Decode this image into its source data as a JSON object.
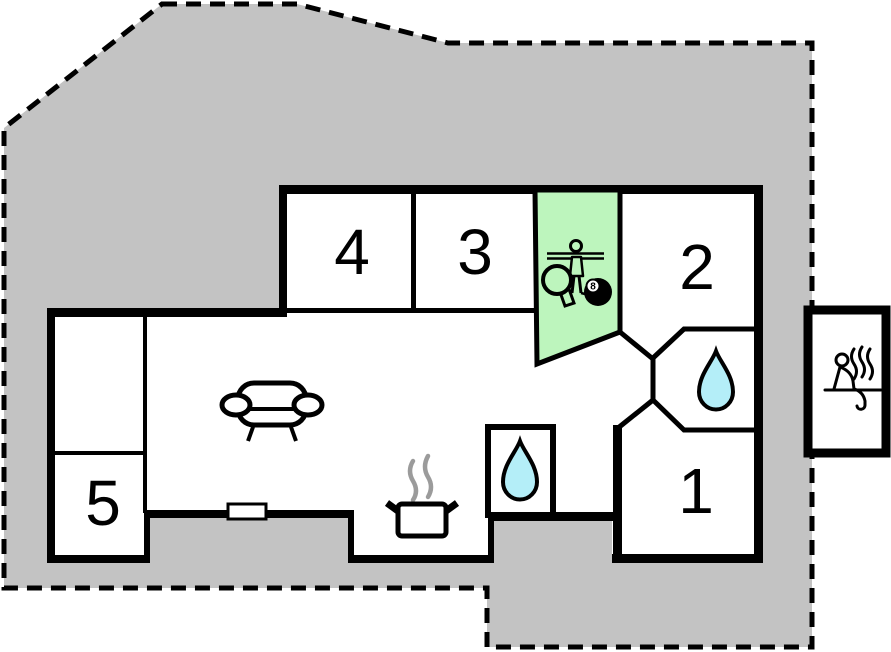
{
  "title": "Holiday home floor plan",
  "colors": {
    "plot_gray": "#c3c3c3",
    "game_room_green": "#bdf5bd",
    "water_drop_cyan": "#b4eef8",
    "wall_black": "#000000",
    "steam_gray": "#9b9b9b"
  },
  "rooms": [
    {
      "id": "room-1",
      "label": "1"
    },
    {
      "id": "room-2",
      "label": "2"
    },
    {
      "id": "room-3",
      "label": "3"
    },
    {
      "id": "room-4",
      "label": "4"
    },
    {
      "id": "room-5",
      "label": "5"
    }
  ],
  "game_room": {
    "eight_ball_label": "8",
    "icons": [
      "foosball-player-icon",
      "table-tennis-paddle-icon",
      "billiard-8ball-icon"
    ]
  },
  "features": {
    "bathroom_icons": [
      "water-drop-icon",
      "water-drop-icon"
    ],
    "living_room_icon": "sofa-icon",
    "kitchen_icon": "cooking-pot-icon",
    "sauna_icon": "sauna-person-icon",
    "boundary_style": "dashed",
    "window_count": 1
  }
}
